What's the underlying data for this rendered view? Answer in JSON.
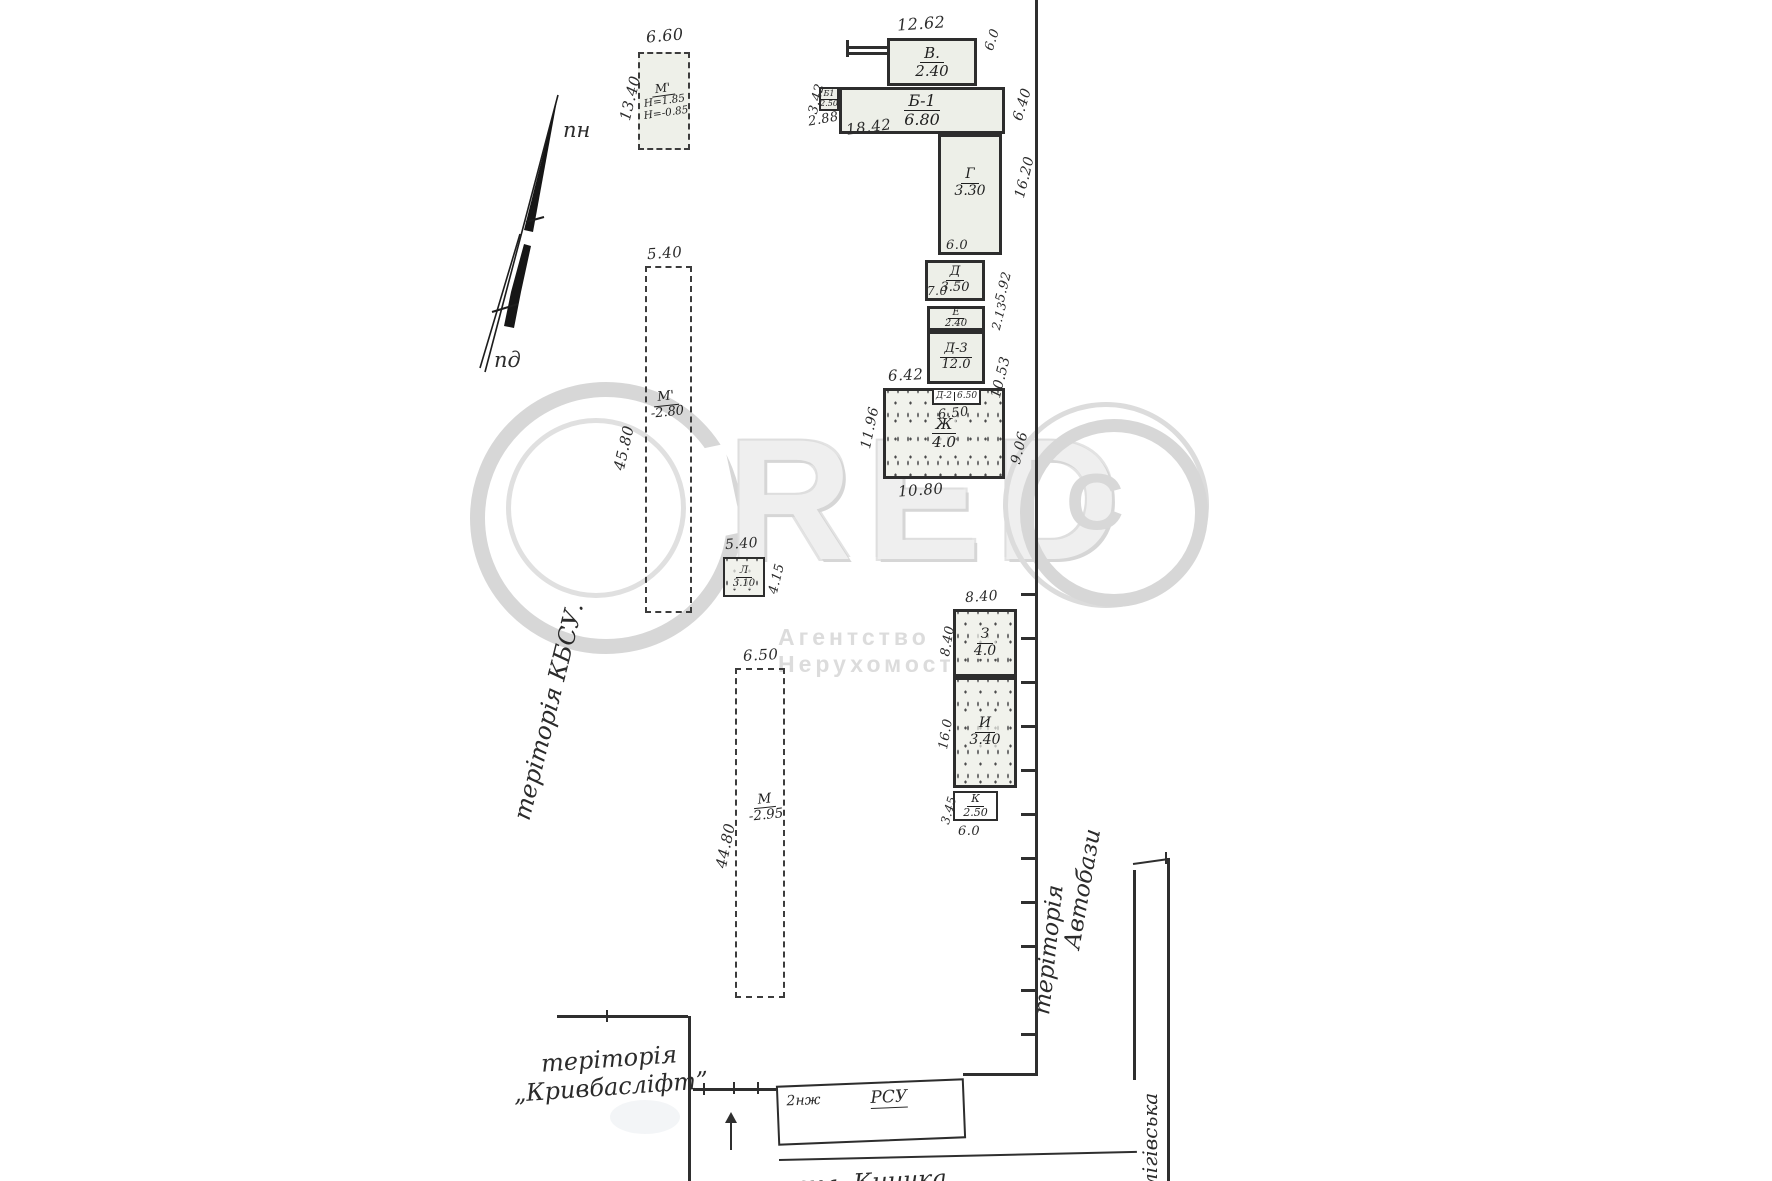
{
  "watermark": {
    "letters": "RED",
    "inner_c": "C",
    "subtitle": "Агентство Нерухомості"
  },
  "compass": {
    "north": "пн",
    "south": "пд"
  },
  "territories": {
    "left": "теріторія    КБСУ.",
    "right_1": "теріторія",
    "right_2": "Автобази",
    "bottom_1": "теріторія",
    "bottom_2": "„Кривбасліфт”",
    "street_bottom": "вул. Кничка",
    "street_right": "лігівська"
  },
  "blocks": {
    "m_top": {
      "name": "М'",
      "h1": "Н=1.85",
      "h2": "Н=-0.85",
      "dim_top": "6.60",
      "dim_left": "13.40"
    },
    "v": {
      "name": "В.",
      "area": "2.40",
      "dim_top": "12.62",
      "dim_right": "6.0"
    },
    "b1s": {
      "name": "Б1",
      "area": "2.50",
      "dim_left": "3.42",
      "dim_bottom": "2.88"
    },
    "b1": {
      "name": "Б-1",
      "area": "6.80",
      "dim_bottom": "18.42",
      "dim_right": "6.40"
    },
    "g": {
      "name": "Г",
      "area": "3.30",
      "dim_right": "16.20",
      "dim_bottom": "6.0"
    },
    "d": {
      "name": "Д",
      "area": "3.50",
      "dim_bottom": "7.0",
      "dim_right": "5.92"
    },
    "e": {
      "name": "Е",
      "area": "2.40",
      "dim_right": "2.13"
    },
    "d3": {
      "name": "Д-3",
      "area": "12.0",
      "dim_right": "10.53"
    },
    "d2": {
      "name": "Д-2",
      "area": "6.50",
      "dim_bottom": "6.50"
    },
    "zh": {
      "name": "Ж",
      "area": "4.0",
      "dim_top": "6.42",
      "dim_left": "11.96",
      "dim_bottom": "10.80",
      "dim_right": "9.06"
    },
    "m_mid": {
      "name": "М'",
      "area": "-2.80",
      "dim_top": "5.40",
      "dim_left": "45.80"
    },
    "l": {
      "name": "Л",
      "area": "3.10",
      "dim_top": "5.40",
      "dim_right": "4.15"
    },
    "m_low": {
      "name": "М",
      "area": "-2.95",
      "dim_top": "6.50",
      "dim_left": "44.80"
    },
    "z": {
      "name": "З",
      "area": "4.0",
      "dim_top": "8.40",
      "dim_left": "8.40"
    },
    "i": {
      "name": "И",
      "area": "3.40",
      "dim_left": "16.0"
    },
    "k": {
      "name": "К",
      "area": "2.50",
      "dim_left": "3.45",
      "dim_bottom": "6.0"
    },
    "rsu": {
      "name": "РСУ",
      "floors": "2нж"
    }
  }
}
